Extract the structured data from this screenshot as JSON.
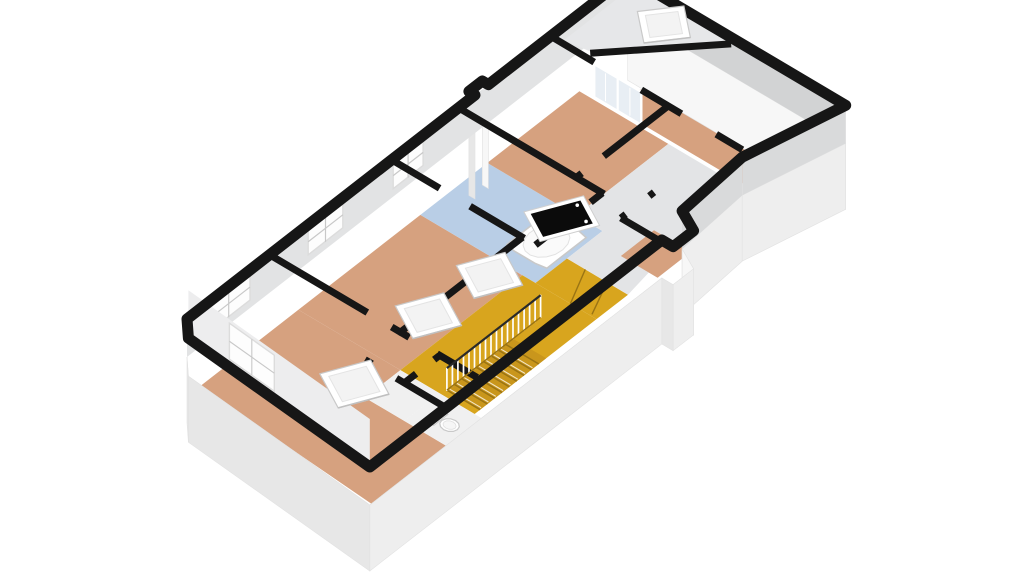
{
  "canvas": {
    "width": 1024,
    "height": 576,
    "background": "#ffffff"
  },
  "palette": {
    "wall_top": "#161616",
    "wall_face": "#d9dadb",
    "wall_face_west": "#d2d3d4",
    "wall_face_tall": "#e2e3e4",
    "roof_slope": "#ededee",
    "roof_slope_right": "#e6e7e9",
    "slab_south": "#eeeeee",
    "slab_east": "#f7f7f7",
    "slab_diag": "#f2f2f2",
    "slab_west": "#e7e7e7",
    "slab_edge": "#e2e2e2",
    "floor_wood": "#d6a17f",
    "floor_hall": "#d8a51e",
    "stair_base": "#c9961c",
    "stair_tread_line": "#9a7414",
    "floor_bath": "#b9cee6",
    "floor_corridor": "#e3e4e6",
    "floor_service": "#f0f0f0",
    "window_white": "#fdfdfd",
    "window_mullion": "#c8c8c8",
    "glass_tint": "#e8eef4",
    "skylight_white": "#ffffff",
    "skylight_inner": "#f3f3f3",
    "skylight_edge": "#c9c9c9",
    "roof_window_glass": "#0b0b0b",
    "fixture_white": "#ffffff",
    "fixture_edge": "#c9c9c9",
    "railing_white": "#ffffff"
  },
  "elements": {
    "rooms": [
      {
        "id": "room-bedroom-left",
        "floor": "floor_wood"
      },
      {
        "id": "room-bedroom-mid",
        "floor": "floor_wood"
      },
      {
        "id": "room-bathroom",
        "floor": "floor_bath"
      },
      {
        "id": "room-bedroom-top",
        "floor": "floor_wood"
      },
      {
        "id": "room-bedroom-right",
        "floor": "floor_wood"
      },
      {
        "id": "hallway-landing",
        "floor": "floor_hall"
      },
      {
        "id": "stair-winders",
        "floor": "floor_hall"
      },
      {
        "id": "room-corridor",
        "floor": "floor_corridor"
      },
      {
        "id": "room-vestibule",
        "floor": "floor_service"
      },
      {
        "id": "room-toilet",
        "floor": "floor_service"
      },
      {
        "id": "room-alcove",
        "floor": "floor_wood"
      }
    ],
    "fixtures": [
      {
        "id": "bathtub"
      },
      {
        "id": "toilet"
      }
    ],
    "skylights": [
      {
        "id": "skylight-bedroom-left"
      },
      {
        "id": "skylight-hall-west"
      },
      {
        "id": "skylight-hall-east"
      },
      {
        "id": "skylight-bedroom-right-slope"
      },
      {
        "id": "roof-window-dark"
      }
    ],
    "windows": [
      {
        "id": "window-bedroom-left"
      },
      {
        "id": "window-bedroom-mid"
      },
      {
        "id": "window-bathroom"
      },
      {
        "id": "window-bevel-roof"
      }
    ],
    "doors": [
      {
        "id": "glass-doors-right-room"
      }
    ],
    "stairs": {
      "id": "staircase-down",
      "treads": 9,
      "railing_spindles": 18
    }
  }
}
